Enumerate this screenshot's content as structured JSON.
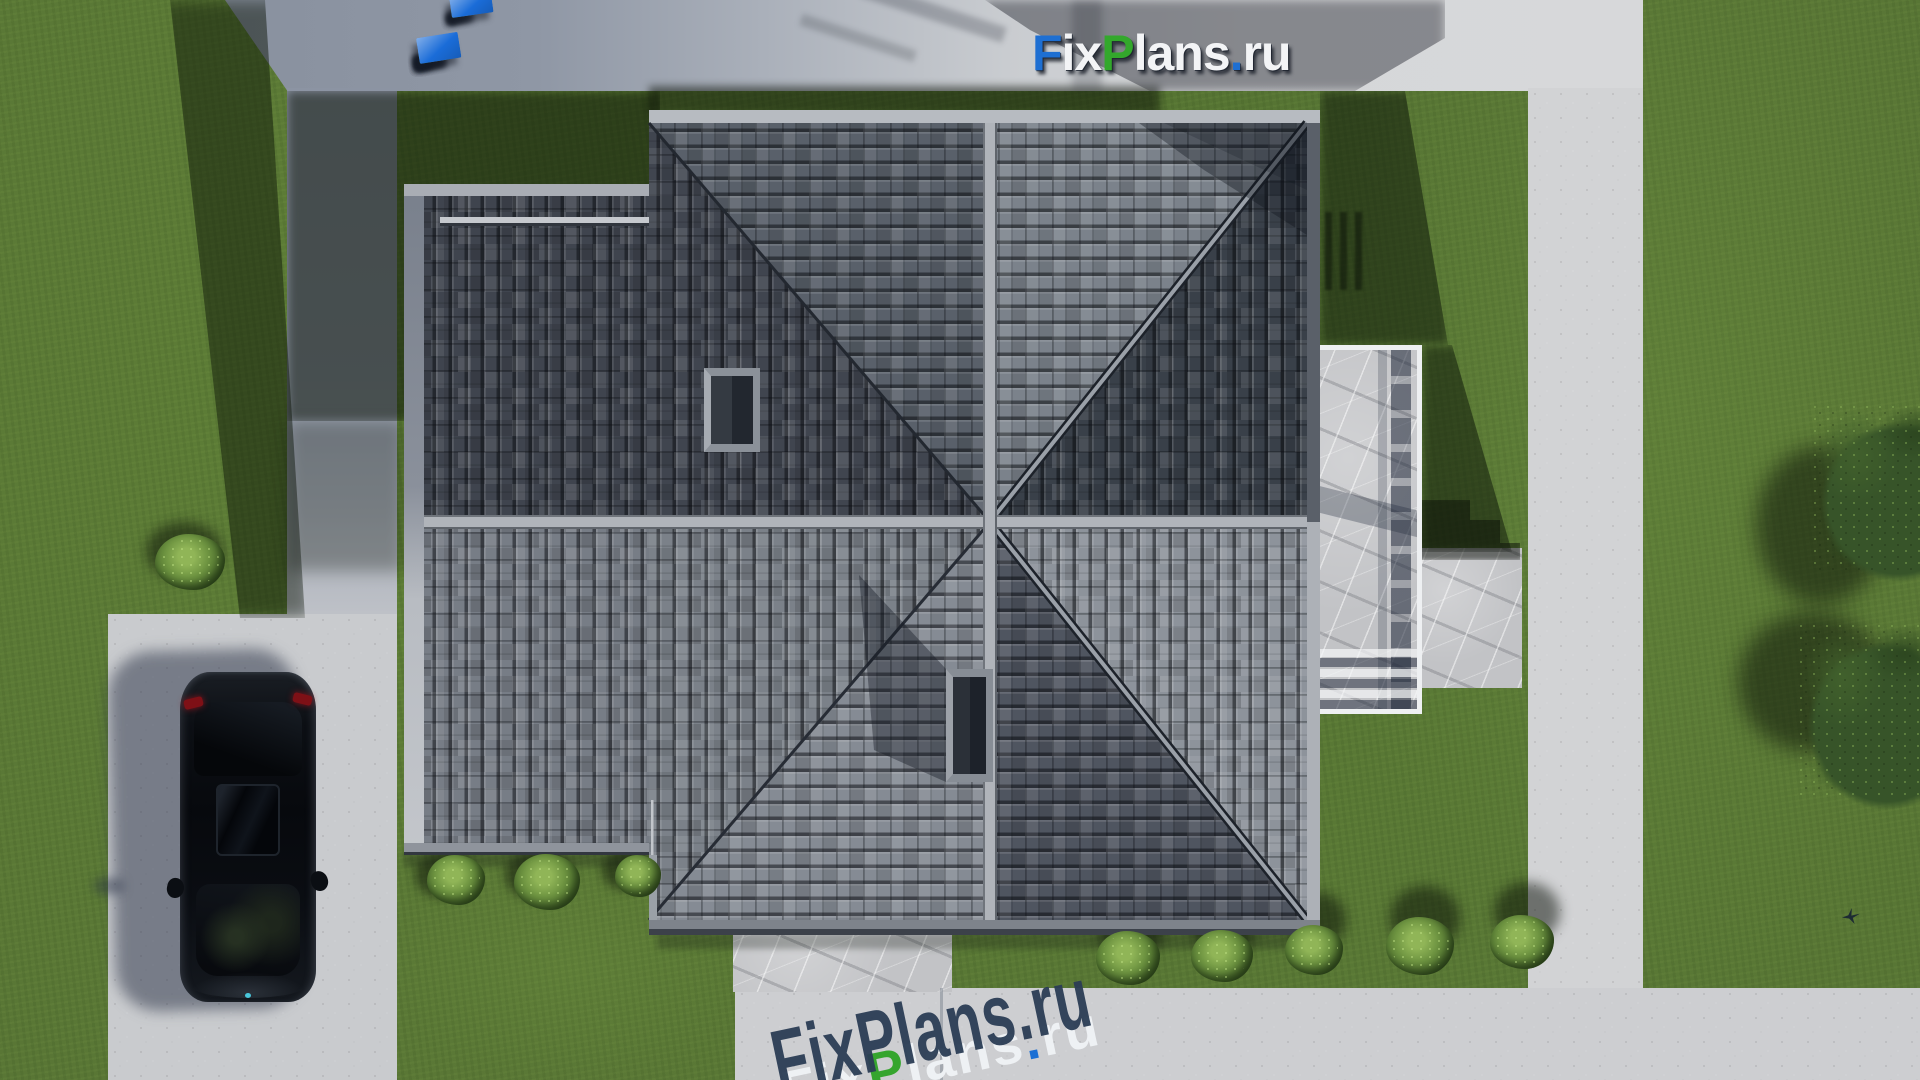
{
  "scene": {
    "title": "Top-down 3D site render of a hip-roof house",
    "source_watermark": "FixPlans.ru"
  },
  "brand": {
    "name": "FixPlans.ru",
    "colors": {
      "blue": "#1a6cd8",
      "green": "#2fae2c",
      "white": "#e9ebee",
      "navy": "#2b3d55"
    },
    "segments": [
      {
        "t": "F",
        "c": "#1e6fd2"
      },
      {
        "t": "ix",
        "c": "#f3f4f6"
      },
      {
        "t": "P",
        "c": "#33a82c"
      },
      {
        "t": "lans",
        "c": "#f3f4f6"
      },
      {
        "t": ".",
        "c": "#1e6fd2"
      },
      {
        "t": "ru",
        "c": "#f3f4f6"
      }
    ],
    "segments_3d": [
      {
        "t": "F",
        "c": "#eef1f4"
      },
      {
        "t": "ix",
        "c": "#eef1f4"
      },
      {
        "t": "P",
        "c": "#35a52e"
      },
      {
        "t": "lans",
        "c": "#eef1f4"
      },
      {
        "t": ".",
        "c": "#1a6fd4"
      },
      {
        "t": "ru",
        "c": "#eef1f4"
      }
    ]
  },
  "palette": {
    "grass": "#587535",
    "grass_shadow": "#22351a",
    "concrete_light": "#d2d3d5",
    "concrete_shaded": "#8c94a3",
    "parking_pad": "#c9cbce",
    "marble": "#c2c3c6",
    "terrace_border": "#eef0f2",
    "roof_dark": "#394049",
    "roof_medium": "#59606a",
    "roof_light": "#8d939b",
    "ridge_cap": "#b0b4ba",
    "fascia": "#b7bbc1",
    "car_body": "#0a0d12",
    "taillight": "#7e1016"
  },
  "roof": {
    "type": "hip roof with pinwheel-shaded slopes, tiled",
    "sector_shades": {
      "n_left": "#59606a",
      "n_right": "#7b828b",
      "e_upper": "#394049",
      "e_lower": "#8d939b",
      "s_right": "#4f5560",
      "s_left": "#858b94",
      "w_lower": "#7b8189",
      "w_upper": "#40454f",
      "wing_upper": "#3f444e",
      "wing_lower": "#777d86"
    },
    "skylights": 2,
    "snow_guard": true
  },
  "landscape": {
    "trees": [
      {
        "n": "tree-right-top",
        "x": 1800,
        "y": 392,
        "w": 175,
        "h": 190
      },
      {
        "n": "tree-right-bottom",
        "x": 1786,
        "y": 610,
        "w": 180,
        "h": 200
      }
    ],
    "bushes": [
      {
        "n": "bush-eave-1",
        "x": 427,
        "y": 855,
        "w": 58,
        "h": 50
      },
      {
        "n": "bush-eave-2",
        "x": 514,
        "y": 854,
        "w": 66,
        "h": 56
      },
      {
        "n": "bush-eave-3",
        "x": 615,
        "y": 855,
        "w": 46,
        "h": 42
      },
      {
        "n": "bush-south-1",
        "x": 1096,
        "y": 931,
        "w": 64,
        "h": 54
      },
      {
        "n": "bush-south-2",
        "x": 1191,
        "y": 930,
        "w": 62,
        "h": 52
      },
      {
        "n": "bush-south-3",
        "x": 1285,
        "y": 925,
        "w": 58,
        "h": 50
      },
      {
        "n": "bush-south-4",
        "x": 1386,
        "y": 917,
        "w": 68,
        "h": 58
      },
      {
        "n": "bush-south-5",
        "x": 1490,
        "y": 915,
        "w": 64,
        "h": 54
      },
      {
        "n": "bush-driveway",
        "x": 155,
        "y": 534,
        "w": 70,
        "h": 56
      }
    ]
  },
  "blocks_rows": [
    {
      "n": "logo-blocks-upper",
      "x": 452,
      "y": 18,
      "rot": -8,
      "gap": 6,
      "blocks": [
        {
          "w": 18,
          "h": 9,
          "c": "white"
        },
        {
          "w": 22,
          "h": 10,
          "c": "white"
        },
        {
          "w": 8,
          "h": 8,
          "c": "white"
        },
        {
          "w": 26,
          "h": 12,
          "c": "green"
        },
        {
          "w": 26,
          "h": 12,
          "c": "white"
        },
        {
          "w": 10,
          "h": 10,
          "c": "green"
        },
        {
          "w": 42,
          "h": 20,
          "c": "blue"
        }
      ]
    },
    {
      "n": "logo-blocks-lower",
      "x": 420,
      "y": 64,
      "rot": -9,
      "gap": 4,
      "blocks": [
        {
          "w": 18,
          "h": 11,
          "c": "white"
        },
        {
          "w": 18,
          "h": 11,
          "c": "white"
        },
        {
          "w": 14,
          "h": 12,
          "c": "blue"
        },
        {
          "w": 30,
          "h": 13,
          "c": "white"
        },
        {
          "w": 26,
          "h": 13,
          "c": "white"
        },
        {
          "w": 30,
          "h": 14,
          "c": "white"
        },
        {
          "w": 9,
          "h": 10,
          "c": "white"
        },
        {
          "w": 32,
          "h": 15,
          "c": "green"
        },
        {
          "w": 28,
          "h": 15,
          "c": "white"
        },
        {
          "w": 11,
          "h": 12,
          "c": "green"
        },
        {
          "w": 42,
          "h": 26,
          "c": "blue"
        }
      ]
    }
  ],
  "shadows": [
    {
      "n": "shadow-left-lawn",
      "t": "poly",
      "x": 160,
      "y": 0,
      "w": 150,
      "h": 618,
      "clip": "polygon(10px 0px,105px 0px,145px 618px,80px 618px)",
      "c": "rgba(10,18,6,.48)",
      "blur": 8
    },
    {
      "n": "shadow-inner-lawn",
      "t": "poly",
      "x": 287,
      "y": 91,
      "w": 373,
      "h": 330,
      "clip": "polygon(0px 0px,373px 0px,373px 99px,117px 99px,117px 330px,0px 330px)",
      "c": "rgba(9,16,6,.55)",
      "blur": 5
    },
    {
      "n": "shadow-inner-lawn-2",
      "t": "rect",
      "x": 287,
      "y": 421,
      "w": 117,
      "h": 150,
      "c": "rgba(9,16,6,.3)",
      "blur": 8
    },
    {
      "n": "shadow-lawn-north",
      "t": "rect",
      "x": 649,
      "y": 86,
      "w": 511,
      "h": 28,
      "c": "rgba(9,16,6,.5)",
      "blur": 4
    },
    {
      "n": "shadow-band-tree",
      "t": "poly",
      "x": 985,
      "y": 0,
      "w": 460,
      "h": 91,
      "clip": "polygon(0px 0px,460px 0px,460px 38px,370px 91px,165px 91px,45px 30px)",
      "c": "rgba(14,18,28,.4)",
      "blur": 5
    },
    {
      "n": "shadow-band-streak-1",
      "t": "rect",
      "x": 858,
      "y": 4,
      "w": 150,
      "h": 16,
      "rot": 18,
      "c": "rgba(14,20,30,.22)",
      "blur": 3
    },
    {
      "n": "shadow-band-streak-2",
      "t": "rect",
      "x": 798,
      "y": 32,
      "w": 120,
      "h": 12,
      "rot": 18,
      "c": "rgba(14,20,30,.18)",
      "blur": 3
    },
    {
      "n": "shadow-band-streak-3",
      "t": "rect",
      "x": 1072,
      "y": 0,
      "w": 30,
      "h": 91,
      "c": "rgba(14,20,30,.2)",
      "blur": 4
    },
    {
      "n": "shadow-right-lawn-1",
      "t": "poly",
      "x": 1320,
      "y": 91,
      "w": 130,
      "h": 254,
      "clip": "polygon(0px 0px,85px 0px,128px 254px,0px 254px)",
      "c": "rgba(8,15,6,.5)",
      "blur": 5
    },
    {
      "n": "shadow-right-lawn-2",
      "t": "poly",
      "x": 1422,
      "y": 345,
      "w": 92,
      "h": 207,
      "clip": "polygon(0px 0px,30px 0px,90px 207px,0px 207px)",
      "c": "rgba(8,15,6,.5)",
      "blur": 5
    },
    {
      "n": "shadow-walk-steps",
      "t": "poly",
      "x": 1412,
      "y": 498,
      "w": 110,
      "h": 62,
      "clip": "polygon(0px 2px,58px 2px,58px 22px,88px 22px,88px 45px,108px 45px,108px 62px,0px 62px)",
      "c": "rgba(10,14,8,.5)",
      "blur": 2
    },
    {
      "n": "shadow-ladder",
      "t": "stripes",
      "x": 1325,
      "y": 212,
      "w": 42,
      "h": 78,
      "css": "repeating-linear-gradient(90deg, rgba(10,16,8,.5) 0 7px, transparent 7px 15px)",
      "blur": 1
    },
    {
      "n": "shadow-car",
      "t": "rect",
      "x": 112,
      "y": 650,
      "w": 188,
      "h": 360,
      "br": 44,
      "rot": -1.5,
      "c": "rgba(38,46,66,.5)",
      "blur": 7
    },
    {
      "n": "shadow-car-mirror",
      "t": "rect",
      "x": 94,
      "y": 878,
      "w": 30,
      "h": 16,
      "br": 8,
      "c": "rgba(38,46,66,.45)",
      "blur": 5
    },
    {
      "n": "shadow-bush-eave-1",
      "t": "ell",
      "x": 415,
      "y": 852,
      "w": 60,
      "h": 46,
      "c": "rgba(8,14,6,.5)",
      "blur": 5
    },
    {
      "n": "shadow-bush-eave-2",
      "t": "ell",
      "x": 505,
      "y": 850,
      "w": 68,
      "h": 50,
      "c": "rgba(8,14,6,.5)",
      "blur": 5
    },
    {
      "n": "shadow-bush-eave-3",
      "t": "ell",
      "x": 602,
      "y": 850,
      "w": 48,
      "h": 40,
      "c": "rgba(8,14,6,.5)",
      "blur": 5
    },
    {
      "n": "shadow-bush-south-1",
      "t": "ell",
      "x": 1098,
      "y": 898,
      "w": 66,
      "h": 62,
      "c": "rgba(8,14,6,.5)",
      "blur": 6
    },
    {
      "n": "shadow-bush-south-2",
      "t": "ell",
      "x": 1192,
      "y": 896,
      "w": 64,
      "h": 60,
      "c": "rgba(8,14,6,.5)",
      "blur": 6
    },
    {
      "n": "shadow-bush-south-3",
      "t": "ell",
      "x": 1286,
      "y": 892,
      "w": 60,
      "h": 56,
      "c": "rgba(8,14,6,.5)",
      "blur": 6
    },
    {
      "n": "shadow-bush-south-4",
      "t": "ell",
      "x": 1390,
      "y": 886,
      "w": 70,
      "h": 64,
      "c": "rgba(8,14,6,.5)",
      "blur": 6
    },
    {
      "n": "shadow-bush-south-5",
      "t": "ell",
      "x": 1494,
      "y": 882,
      "w": 66,
      "h": 60,
      "c": "rgba(8,14,6,.5)",
      "blur": 6
    },
    {
      "n": "shadow-bush-driveway",
      "t": "ell",
      "x": 146,
      "y": 522,
      "w": 76,
      "h": 58,
      "c": "rgba(8,14,6,.5)",
      "blur": 6
    },
    {
      "n": "shadow-tree-top",
      "t": "ell",
      "x": 1756,
      "y": 446,
      "w": 130,
      "h": 158,
      "c": "rgba(8,14,5,.5)",
      "blur": 10
    },
    {
      "n": "shadow-tree-bottom",
      "t": "ell",
      "x": 1738,
      "y": 612,
      "w": 148,
      "h": 140,
      "c": "rgba(8,14,5,.5)",
      "blur": 10
    },
    {
      "n": "shadow-eave-south",
      "t": "rect",
      "x": 657,
      "y": 933,
      "w": 663,
      "h": 16,
      "c": "rgba(18,24,18,.28)",
      "blur": 3
    },
    {
      "n": "shadow-eave-wing",
      "t": "rect",
      "x": 404,
      "y": 853,
      "w": 249,
      "h": 14,
      "c": "rgba(18,24,18,.28)",
      "blur": 3
    }
  ]
}
